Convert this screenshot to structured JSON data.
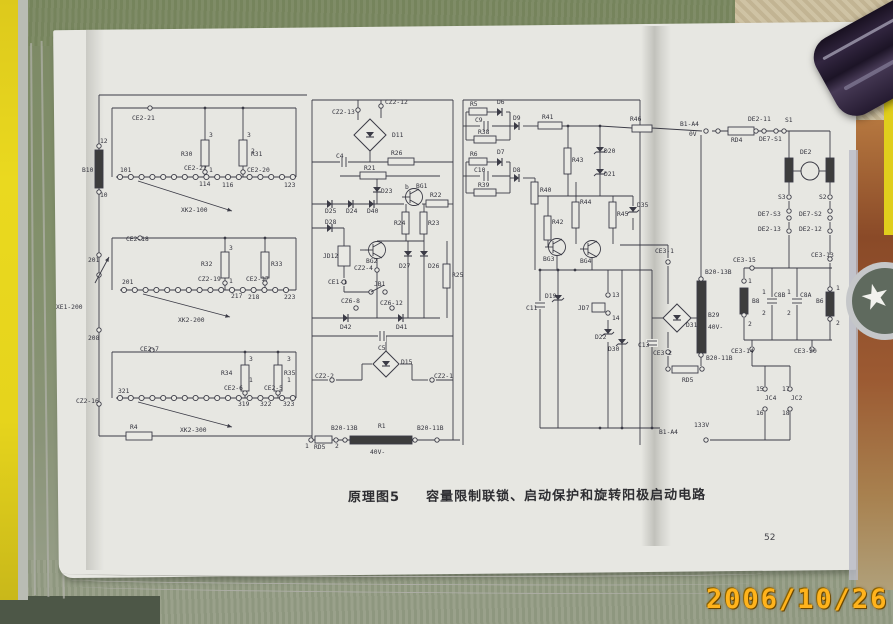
{
  "photo": {
    "date_stamp": "2006/10/26",
    "colors": {
      "fabric_green": "#7d8a66",
      "paper": "#e7e7e2",
      "edge_yellow": "#e6d41c",
      "book_cover_red": "#8a4a28",
      "ink": "#3b3b46",
      "date_orange": "#ffb31c"
    }
  },
  "page": {
    "caption_label": "原理图5",
    "caption_title": "容量限制联锁、启动保护和旋转阳极启动电路",
    "page_number": "52"
  },
  "schematic": {
    "labels": [
      [
        "12",
        100,
        143
      ],
      [
        "B10",
        82,
        172
      ],
      [
        "10",
        100,
        197
      ],
      [
        "CE2-21",
        132,
        120
      ],
      [
        "101",
        120,
        172
      ],
      [
        "R30",
        181,
        156
      ],
      [
        "R31",
        251,
        156
      ],
      [
        "3",
        209,
        137
      ],
      [
        "1",
        209,
        172
      ],
      [
        "3",
        247,
        137
      ],
      [
        "2",
        251,
        153
      ],
      [
        "CE2-22",
        184,
        170
      ],
      [
        "CE2-20",
        247,
        172
      ],
      [
        "114",
        199,
        186
      ],
      [
        "116",
        222,
        187
      ],
      [
        "123",
        284,
        187
      ],
      [
        "XK2-100",
        181,
        212
      ],
      [
        "CE2-18",
        126,
        241
      ],
      [
        "201",
        122,
        284
      ],
      [
        "R32",
        201,
        266
      ],
      [
        "R33",
        271,
        266
      ],
      [
        "3",
        229,
        250
      ],
      [
        "1",
        229,
        283
      ],
      [
        "CZ2-19",
        198,
        281
      ],
      [
        "CE2-17",
        246,
        281
      ],
      [
        "217",
        231,
        298
      ],
      [
        "218",
        248,
        299
      ],
      [
        "223",
        284,
        299
      ],
      [
        "XK2-200",
        178,
        322
      ],
      [
        "201",
        88,
        262
      ],
      [
        "XE1-200",
        56,
        309
      ],
      [
        "208",
        88,
        340
      ],
      [
        "CE2-7",
        140,
        351
      ],
      [
        "321",
        118,
        393
      ],
      [
        "R34",
        221,
        375
      ],
      [
        "R35",
        284,
        375
      ],
      [
        "3",
        249,
        361
      ],
      [
        "3",
        287,
        361
      ],
      [
        "1",
        249,
        382
      ],
      [
        "1",
        287,
        382
      ],
      [
        "CE2-6",
        224,
        390
      ],
      [
        "CE2-5",
        264,
        390
      ],
      [
        "319",
        238,
        406
      ],
      [
        "322",
        260,
        406
      ],
      [
        "323",
        283,
        406
      ],
      [
        "XK2-300",
        180,
        432
      ],
      [
        "CZ2-16",
        76,
        403
      ],
      [
        "R4",
        130,
        429
      ],
      [
        "CZ2-13",
        332,
        114
      ],
      [
        "CZ2-12",
        385,
        104
      ],
      [
        "D11",
        392,
        137
      ],
      [
        "C4",
        336,
        158
      ],
      [
        "R26",
        391,
        155
      ],
      [
        "R21",
        364,
        170
      ],
      [
        "D23",
        381,
        193
      ],
      [
        "D25",
        325,
        213
      ],
      [
        "D24",
        346,
        213
      ],
      [
        "D40",
        367,
        213
      ],
      [
        "b",
        405,
        189
      ],
      [
        "BG1",
        416,
        188
      ],
      [
        "R22",
        430,
        197
      ],
      [
        "R24",
        394,
        225
      ],
      [
        "R23",
        428,
        225
      ],
      [
        "D28",
        325,
        224
      ],
      [
        "JD12",
        323,
        258
      ],
      [
        "BG2",
        366,
        263
      ],
      [
        "D27",
        399,
        268
      ],
      [
        "D26",
        428,
        268
      ],
      [
        "R25",
        452,
        277
      ],
      [
        "CZ2-4",
        354,
        270
      ],
      [
        "CE1-1",
        328,
        284
      ],
      [
        "JB1",
        374,
        286
      ],
      [
        "CZ6-8",
        341,
        303
      ],
      [
        "CZ6-12",
        380,
        305
      ],
      [
        "D42",
        340,
        329
      ],
      [
        "D41",
        396,
        329
      ],
      [
        "C5",
        378,
        350
      ],
      [
        "D15",
        401,
        364
      ],
      [
        "CZ2-2",
        315,
        378
      ],
      [
        "CZ2-1",
        434,
        378
      ],
      [
        "B20-13B",
        331,
        430
      ],
      [
        "R1",
        378,
        428
      ],
      [
        "B20-11B",
        417,
        430
      ],
      [
        "40V-",
        370,
        454
      ],
      [
        "1",
        305,
        448
      ],
      [
        "RD5",
        314,
        449
      ],
      [
        "2",
        335,
        448
      ],
      [
        "R5",
        470,
        106
      ],
      [
        "D6",
        497,
        104
      ],
      [
        "C9",
        475,
        122
      ],
      [
        "R38",
        478,
        134
      ],
      [
        "D9",
        513,
        120
      ],
      [
        "R41",
        542,
        119
      ],
      [
        "R6",
        470,
        156
      ],
      [
        "D7",
        497,
        154
      ],
      [
        "C10",
        474,
        172
      ],
      [
        "D8",
        513,
        172
      ],
      [
        "R39",
        478,
        187
      ],
      [
        "R40",
        540,
        192
      ],
      [
        "R43",
        572,
        162
      ],
      [
        "D20",
        604,
        153
      ],
      [
        "D21",
        604,
        176
      ],
      [
        "R42",
        552,
        224
      ],
      [
        "R44",
        580,
        204
      ],
      [
        "R45",
        617,
        216
      ],
      [
        "D35",
        637,
        207
      ],
      [
        "BG3",
        543,
        261
      ],
      [
        "BG4",
        580,
        263
      ],
      [
        "D19",
        545,
        298
      ],
      [
        "C11",
        526,
        310
      ],
      [
        "JD7",
        578,
        310
      ],
      [
        "13",
        612,
        297
      ],
      [
        "14",
        612,
        320
      ],
      [
        "D22",
        595,
        339
      ],
      [
        "D30",
        608,
        351
      ],
      [
        "C13",
        638,
        347
      ],
      [
        "R46",
        630,
        121
      ],
      [
        "B1-A4",
        680,
        126
      ],
      [
        "0V",
        689,
        136
      ],
      [
        "CE3-1",
        655,
        253
      ],
      [
        "D31",
        686,
        327
      ],
      [
        "B20-13B",
        705,
        274
      ],
      [
        "B29",
        708,
        317
      ],
      [
        "40V-",
        708,
        329
      ],
      [
        "CE3-2",
        653,
        355
      ],
      [
        "B20-11B",
        706,
        360
      ],
      [
        "RD5",
        682,
        382
      ],
      [
        "RD4",
        731,
        142
      ],
      [
        "DE2-11",
        748,
        121
      ],
      [
        "S1",
        785,
        122
      ],
      [
        "DE7-S1",
        759,
        141
      ],
      [
        "DE2",
        800,
        154
      ],
      [
        "S3",
        778,
        199
      ],
      [
        "S2",
        819,
        199
      ],
      [
        "DE7-S3",
        758,
        216
      ],
      [
        "DE7-S2",
        799,
        216
      ],
      [
        "DE2-13",
        758,
        231
      ],
      [
        "DE2-12",
        799,
        231
      ],
      [
        "CE3-13",
        811,
        257
      ],
      [
        "CE3-15",
        733,
        262
      ],
      [
        "1",
        748,
        283
      ],
      [
        "B8",
        752,
        303
      ],
      [
        "2",
        748,
        326
      ],
      [
        "1",
        762,
        294
      ],
      [
        "C8B",
        774,
        297
      ],
      [
        "2",
        762,
        315
      ],
      [
        "1",
        787,
        294
      ],
      [
        "C8A",
        800,
        297
      ],
      [
        "2",
        787,
        315
      ],
      [
        "B6",
        816,
        303
      ],
      [
        "1",
        836,
        290
      ],
      [
        "2",
        836,
        325
      ],
      [
        "CE3-14",
        731,
        353
      ],
      [
        "CE3-20",
        794,
        353
      ],
      [
        "15",
        756,
        391
      ],
      [
        "17",
        782,
        391
      ],
      [
        "JC4",
        765,
        400
      ],
      [
        "JC2",
        791,
        400
      ],
      [
        "16",
        756,
        415
      ],
      [
        "18",
        782,
        415
      ],
      [
        "133V",
        694,
        427
      ],
      [
        "B1-A4",
        659,
        434
      ]
    ]
  }
}
